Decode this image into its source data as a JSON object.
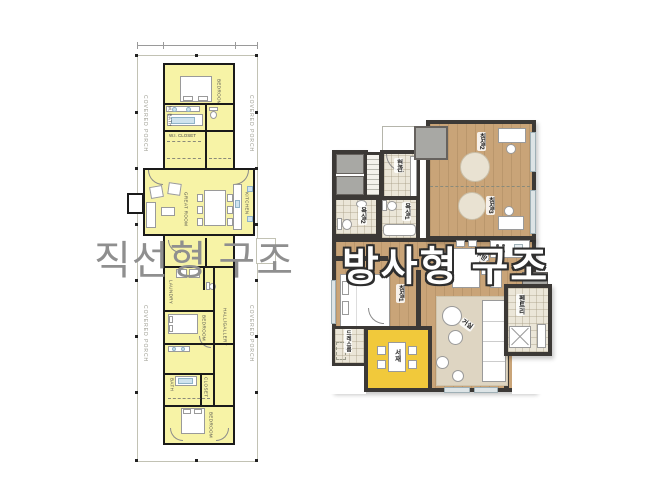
{
  "overlay": {
    "left_title": "직선형 구조",
    "right_title": "방사형 구조",
    "left_title_color": "#8f8f8f",
    "right_title_color": "#ffffff",
    "right_title_outline": "#2e2e2e"
  },
  "left_plan": {
    "style": "linear single-loaded floor plan",
    "room_fill": "#f7f3a6",
    "wall_color": "#1a1a1a",
    "labels": {
      "covered_porch": "COVERED PORCH",
      "bedroom_top": "BEDROOM",
      "master_bath": "M. BATH",
      "wi_closet": "W.I. CLOSET",
      "great_room": "GREAT ROOM",
      "kitchen": "KITCHEN",
      "laundry": "LAUNDRY",
      "bedroom_mid": "BEDROOM",
      "hall_gallery": "HALL/GALLERY",
      "bath": "BATH",
      "closet": "CLOSET",
      "bedroom_bottom": "BEDROOM"
    }
  },
  "right_plan": {
    "style": "radial apartment floor plan",
    "floor_color": "#c9a478",
    "wall_color": "#3c3936",
    "study_highlight": "#f1c93b",
    "labels": {
      "entrance": "현관",
      "bedroom2": "침실2",
      "bedroom3": "침실3",
      "bedroom1": "침실1",
      "bath1": "욕실1",
      "bath2": "욕실2",
      "dress_room": "드레스룸",
      "study": "서재",
      "living_room": "거실",
      "kitchen": "주방",
      "pantry": "펜트리"
    }
  }
}
